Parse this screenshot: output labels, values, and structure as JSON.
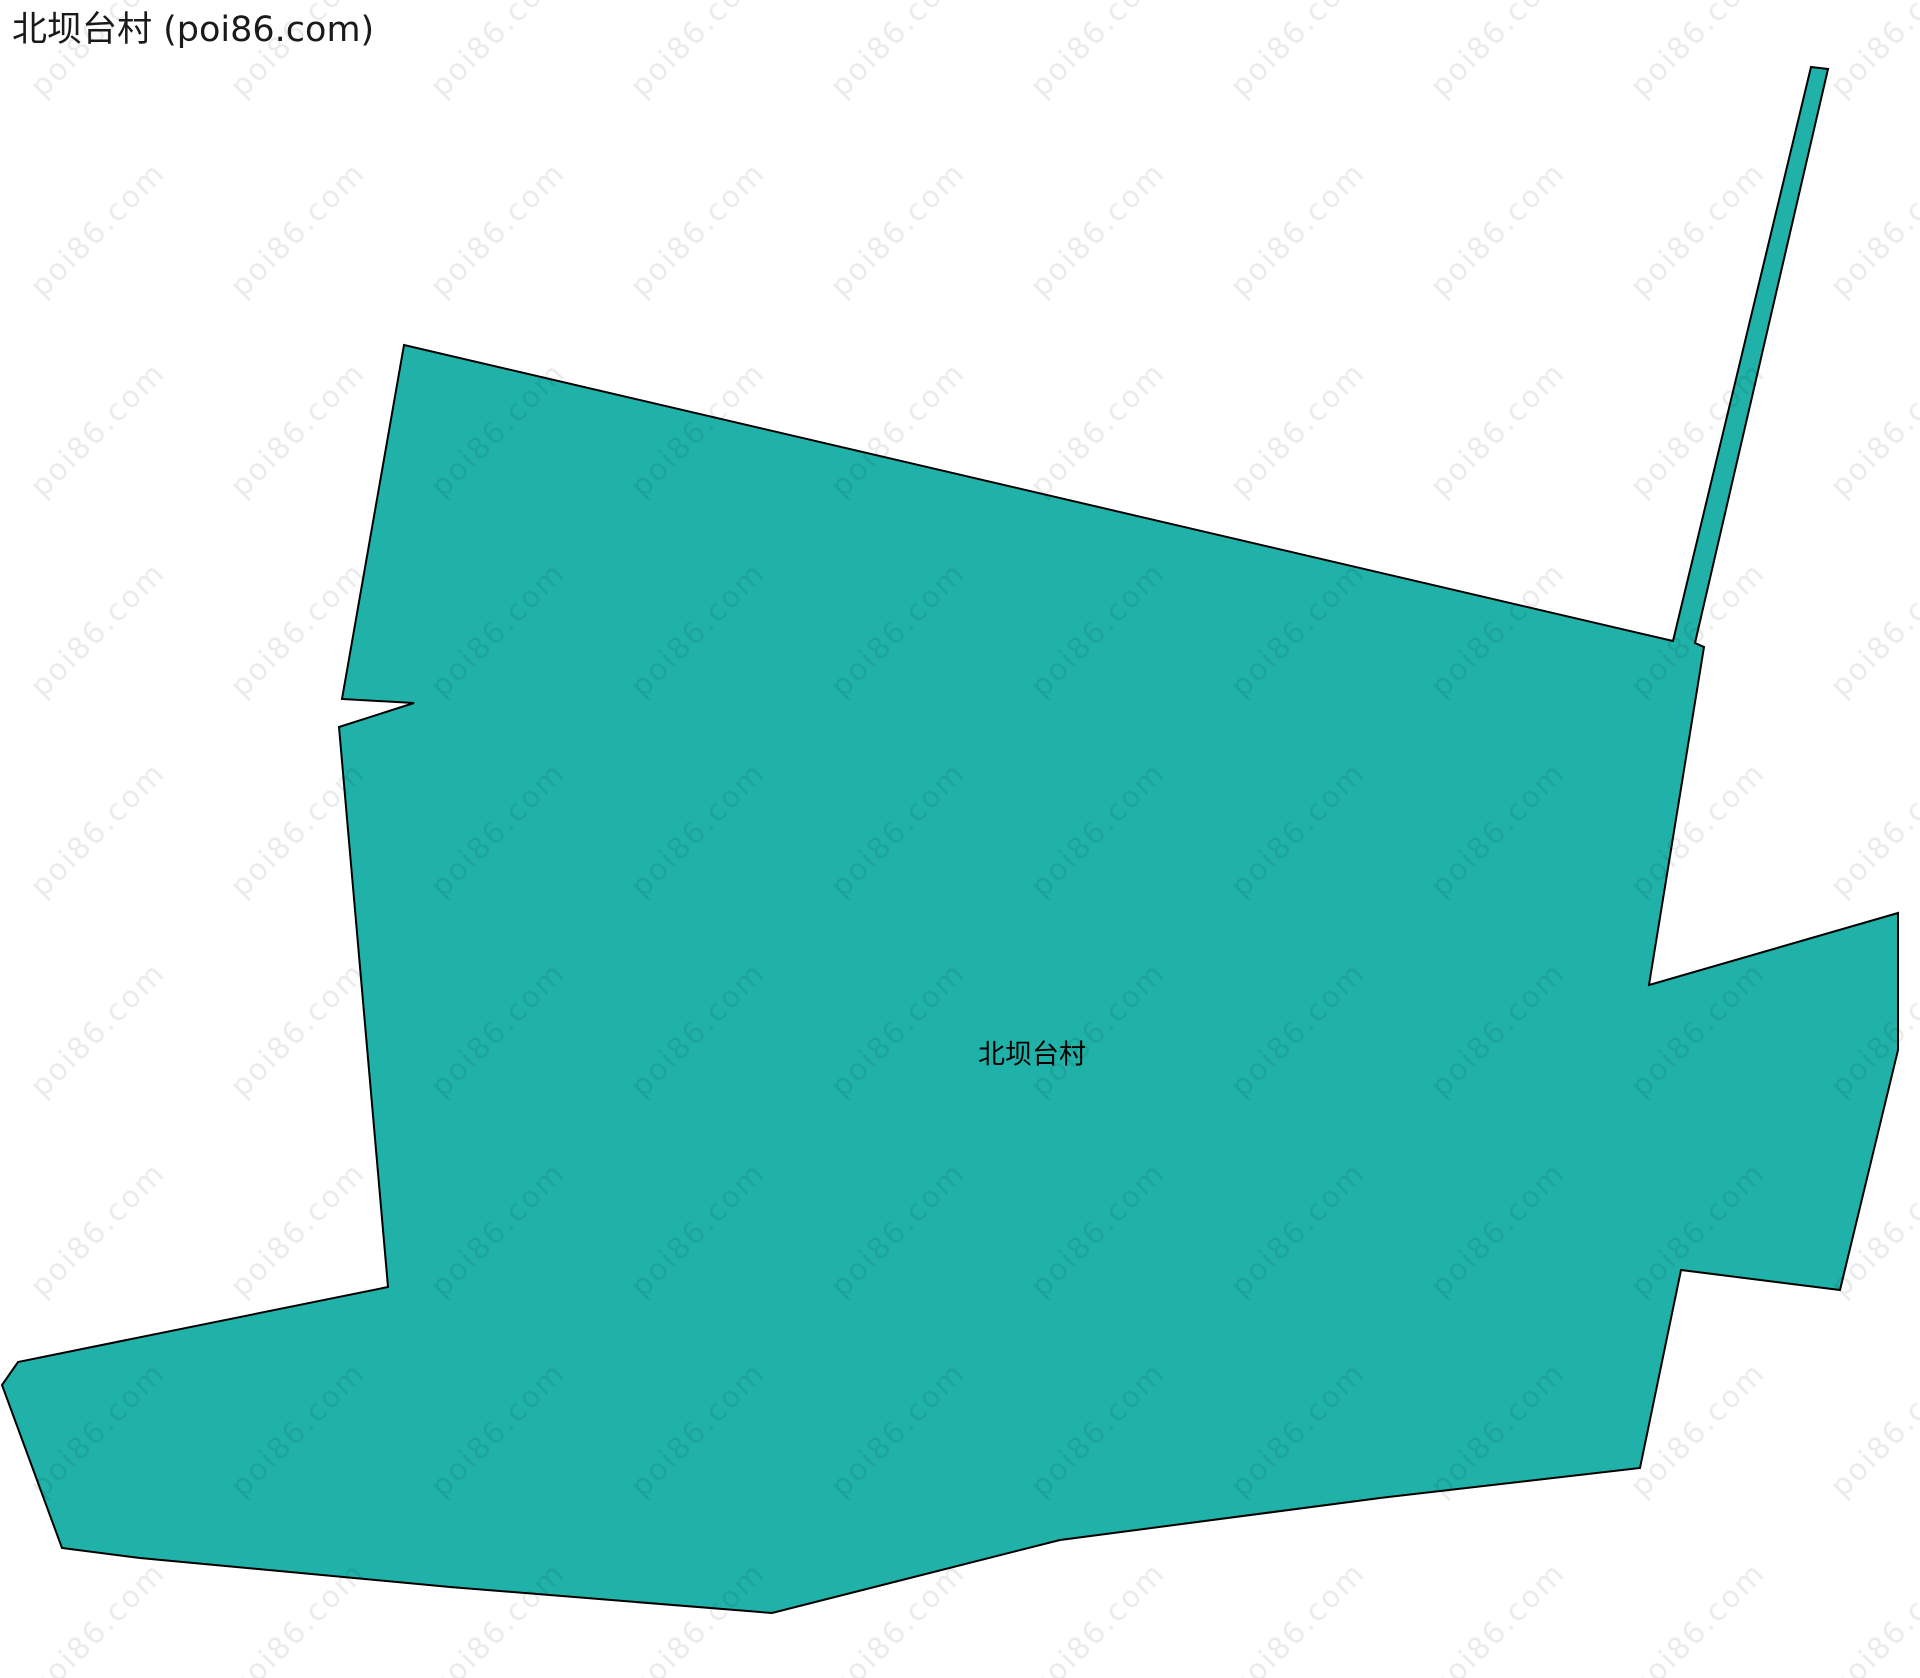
{
  "page": {
    "title": "北坝台村 (poi86.com)"
  },
  "map": {
    "region_label": "北坝台村",
    "label_position": {
      "x": 1032,
      "y": 1052
    },
    "colors": {
      "region_fill": "#20B2A8",
      "region_stroke": "#000000",
      "watermark_text": "rgba(0,0,0,0.08)",
      "title_text": "#1a1a1a",
      "label_text": "#000000"
    },
    "polygon_points": [
      [
        404,
        345
      ],
      [
        1673,
        641
      ],
      [
        1811,
        67
      ],
      [
        1828,
        69
      ],
      [
        1695,
        643
      ],
      [
        1704,
        647
      ],
      [
        1649,
        985
      ],
      [
        1898,
        913
      ],
      [
        1898,
        1050
      ],
      [
        1840,
        1290
      ],
      [
        1681,
        1270
      ],
      [
        1640,
        1468
      ],
      [
        1380,
        1498
      ],
      [
        1060,
        1540
      ],
      [
        772,
        1613
      ],
      [
        450,
        1587
      ],
      [
        140,
        1558
      ],
      [
        62,
        1548
      ],
      [
        2,
        1385
      ],
      [
        18,
        1362
      ],
      [
        388,
        1287
      ],
      [
        339,
        727
      ],
      [
        414,
        703
      ],
      [
        342,
        699
      ]
    ]
  },
  "watermark": {
    "text": "poi86.com"
  }
}
